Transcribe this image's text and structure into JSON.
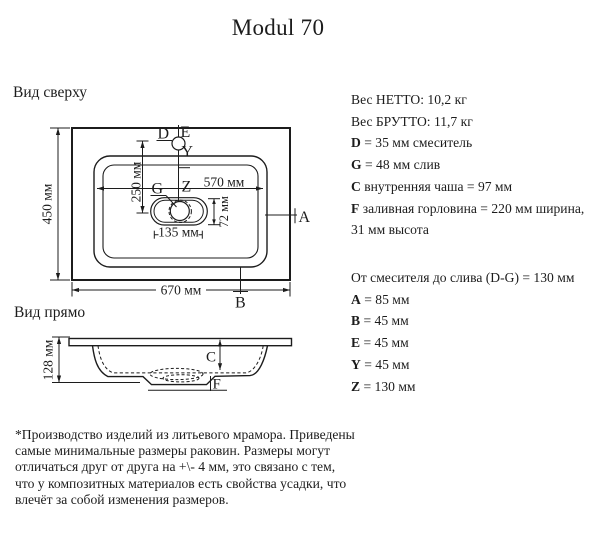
{
  "title": "Modul 70",
  "top_view": {
    "label": "Вид сверху",
    "dim_width": "670 мм",
    "dim_height": "450 мм",
    "dim_inner_width": "570 мм",
    "dim_faucet": "250 мм",
    "dim_drain_len": "135 мм",
    "dim_drain_w": "72 мм",
    "pt_d": "D",
    "pt_e": "E",
    "pt_y": "Y",
    "pt_g": "G",
    "pt_z": "Z",
    "pt_a": "A",
    "pt_b": "B"
  },
  "front_view": {
    "label": "Вид прямо",
    "dim_height": "128 мм",
    "pt_c": "C",
    "pt_f": "F"
  },
  "specs_primary": [
    {
      "key": "",
      "rest": "Вес НЕТТО: 10,2 кг"
    },
    {
      "key": "",
      "rest": "Вес БРУТТО: 11,7 кг"
    },
    {
      "key": "D",
      "rest": " = 35 мм смеситель"
    },
    {
      "key": "G",
      "rest": " = 48 мм слив"
    },
    {
      "key": "C",
      "rest": " внутренняя чаша = 97 мм"
    },
    {
      "key": "F",
      "rest": " заливная горловина = 220 мм ширина,"
    },
    {
      "key": "",
      "rest": "31 мм высота"
    }
  ],
  "specs_secondary": [
    {
      "key": "",
      "rest": "От смесителя до слива (D-G) = 130 мм"
    },
    {
      "key": "A",
      "rest": " = 85 мм"
    },
    {
      "key": "B",
      "rest": " = 45 мм"
    },
    {
      "key": "E",
      "rest": " = 45 мм"
    },
    {
      "key": "Y",
      "rest": " = 45 мм"
    },
    {
      "key": "Z",
      "rest": " = 130 мм"
    }
  ],
  "note_lines": [
    "*Производство изделий из литьевого мрамора. Приведены",
    "самые минимальные размеры раковин. Размеры могут",
    "отличаться друг от друга на +\\- 4 мм, это связано с тем,",
    "что у композитных материалов есть свойства усадки, что",
    "влечёт за собой изменения размеров."
  ],
  "colors": {
    "ink": "#1c1c1c",
    "background": "#ffffff"
  }
}
